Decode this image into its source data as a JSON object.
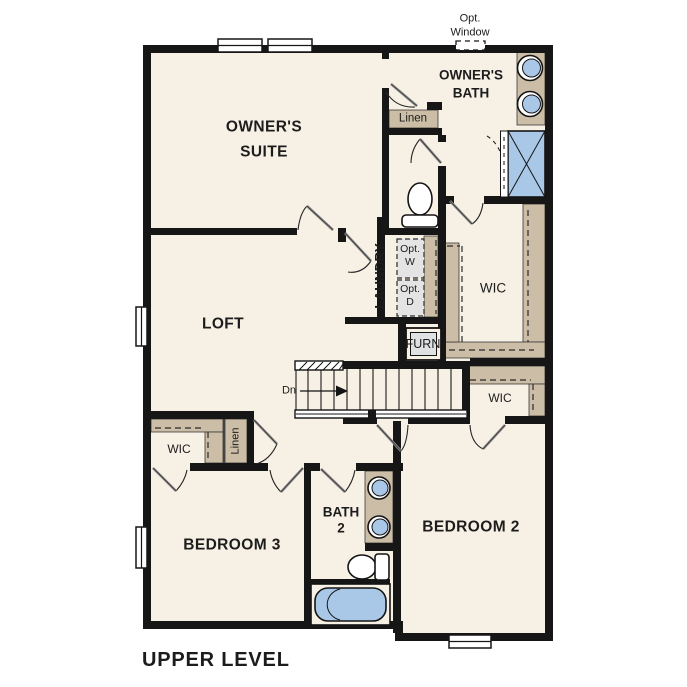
{
  "colors": {
    "floor": "#f7f0e5",
    "wall": "#161616",
    "shelf": "#cbbda6",
    "fixture": "#a9c8e8",
    "appliance": "#e4e4e4",
    "text": "#1c1c1c"
  },
  "labels": {
    "opt_window_line1": "Opt.",
    "opt_window_line2": "Window",
    "owners_suite_line1": "OWNER'S",
    "owners_suite_line2": "SUITE",
    "owners_bath_line1": "OWNER'S",
    "owners_bath_line2": "BATH",
    "linen_upper": "Linen",
    "laundry": "LAUNDRY",
    "opt_w_line1": "Opt.",
    "opt_w_line2": "W",
    "opt_d_line1": "Opt.",
    "opt_d_line2": "D",
    "wic_owners": "WIC",
    "furnace": "FURN",
    "loft": "LOFT",
    "stairs_down": "Dn",
    "wic_bedroom2": "WIC",
    "wic_bedroom3": "WIC",
    "linen_lower": "Linen",
    "bedroom3": "BEDROOM 3",
    "bath2_line1": "BATH",
    "bath2_line2": "2",
    "bedroom2": "BEDROOM 2",
    "plan_title": "UPPER LEVEL"
  }
}
